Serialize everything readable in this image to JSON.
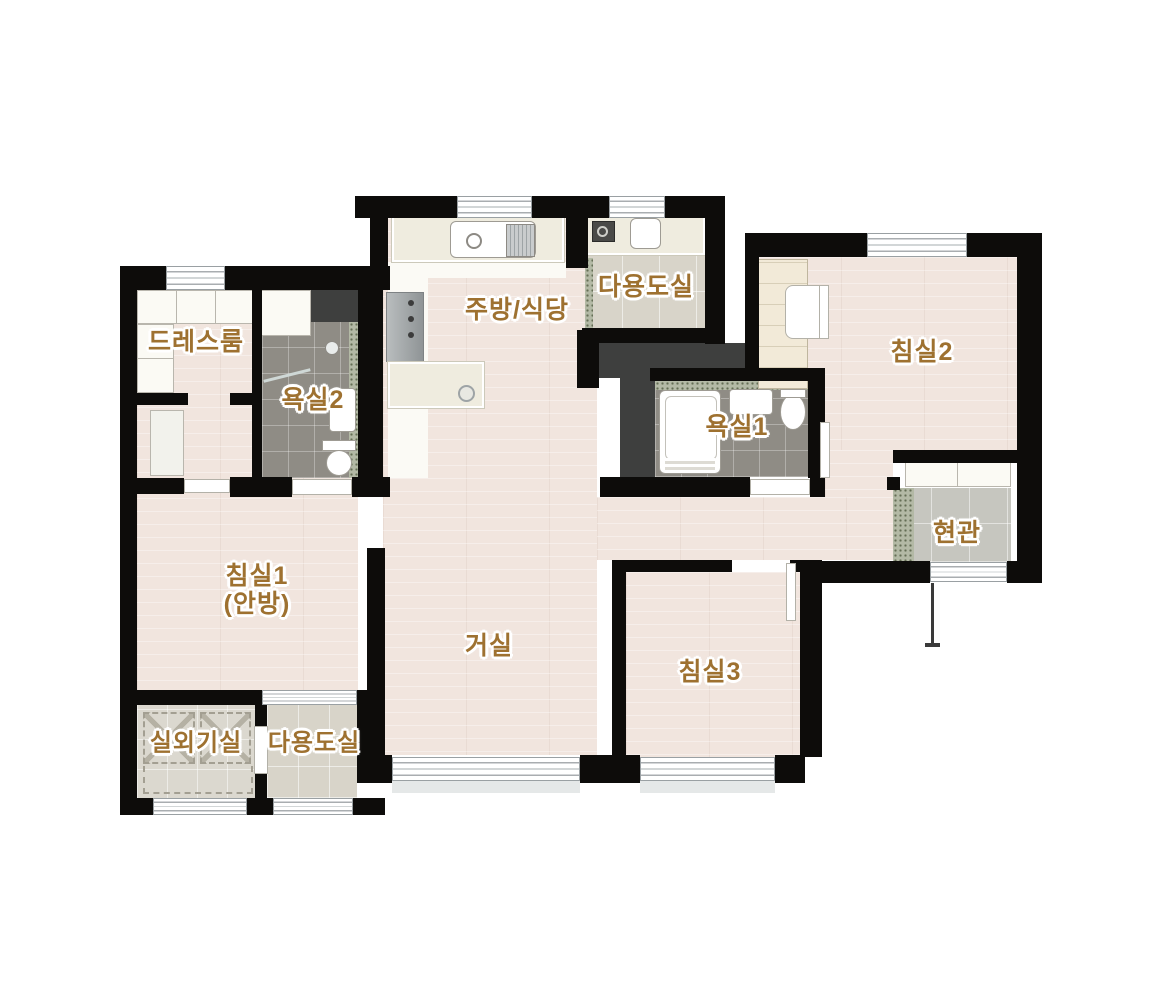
{
  "title": "apartment-floor-plan",
  "rooms": [
    {
      "id": "dressroom",
      "label": "드레스룸"
    },
    {
      "id": "bathroom2",
      "label": "욕실2"
    },
    {
      "id": "kitchen-dining",
      "label": "주방/식당"
    },
    {
      "id": "utility-top",
      "label": "다용도실"
    },
    {
      "id": "bedroom2",
      "label": "침실2"
    },
    {
      "id": "bathroom1",
      "label": "욕실1"
    },
    {
      "id": "entrance",
      "label": "현관"
    },
    {
      "id": "bedroom1",
      "label": "침실1",
      "label2": "(안방)"
    },
    {
      "id": "living-room",
      "label": "거실"
    },
    {
      "id": "bedroom3",
      "label": "침실3"
    },
    {
      "id": "outdoor-unit",
      "label": "실외기실"
    },
    {
      "id": "utility-bottom",
      "label": "다용도실"
    }
  ],
  "colors": {
    "label_text": "#9e7130",
    "label_outline": "#ffffff",
    "wall": "#0d0c0a",
    "wood_floor": "#f1e5de",
    "bath_tile": "#8f8c85",
    "utility_tile": "#d8d4c9",
    "entrance_tile": "#c6c6bf",
    "duct": "#3e3f3e",
    "threshold_speckle": "#b3b9a5",
    "background": "#ffffff"
  }
}
